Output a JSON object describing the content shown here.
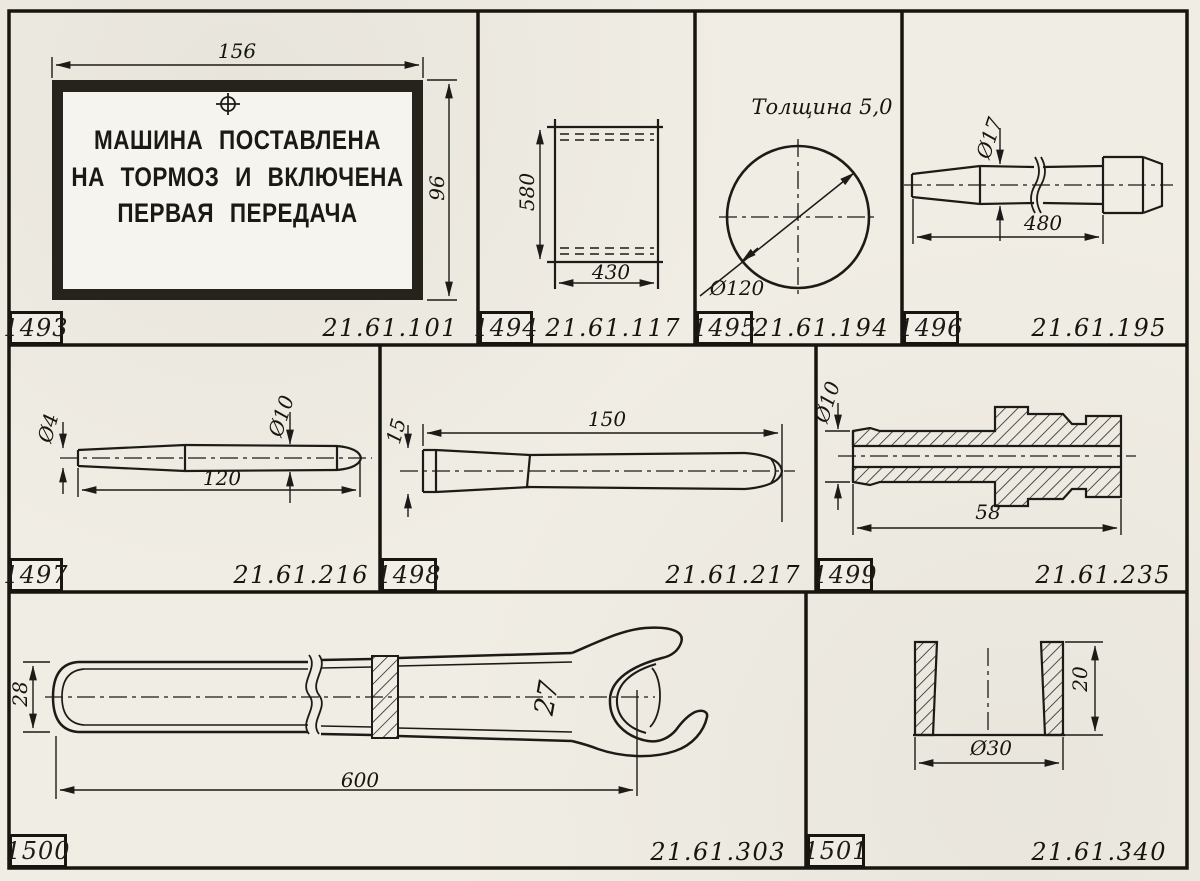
{
  "sheet": {
    "paper_color": "#f0ede5",
    "ink_color": "#1d1b17"
  },
  "panels": [
    {
      "id": "1493",
      "code": "21.61.101",
      "sign": {
        "lines": [
          "МАШИНА ПОСТАВЛЕНА",
          "НА ТОРМОЗ И ВКЛЮЧЕНА",
          "ПЕРВАЯ ПЕРЕДАЧА"
        ]
      },
      "dims": {
        "width": "156",
        "height": "96"
      }
    },
    {
      "id": "1494",
      "code": "21.61.117",
      "dims": {
        "height": "580",
        "width": "430"
      }
    },
    {
      "id": "1495",
      "code": "21.61.194",
      "note": "Толщина 5,0",
      "dims": {
        "diameter": "Ø120"
      }
    },
    {
      "id": "1496",
      "code": "21.61.195",
      "dims": {
        "diameter": "Ø17",
        "length": "480"
      }
    },
    {
      "id": "1497",
      "code": "21.61.216",
      "dims": {
        "tip_diameter": "Ø4",
        "diameter": "Ø10",
        "length": "120"
      }
    },
    {
      "id": "1498",
      "code": "21.61.217",
      "dims": {
        "width": "15",
        "length": "150"
      }
    },
    {
      "id": "1499",
      "code": "21.61.235",
      "dims": {
        "diameter": "Ø10",
        "length": "58"
      }
    },
    {
      "id": "1500",
      "code": "21.61.303",
      "dims": {
        "width": "28",
        "jaw": "27",
        "length": "600"
      }
    },
    {
      "id": "1501",
      "code": "21.61.340",
      "dims": {
        "diameter": "Ø30",
        "height": "20"
      }
    }
  ]
}
